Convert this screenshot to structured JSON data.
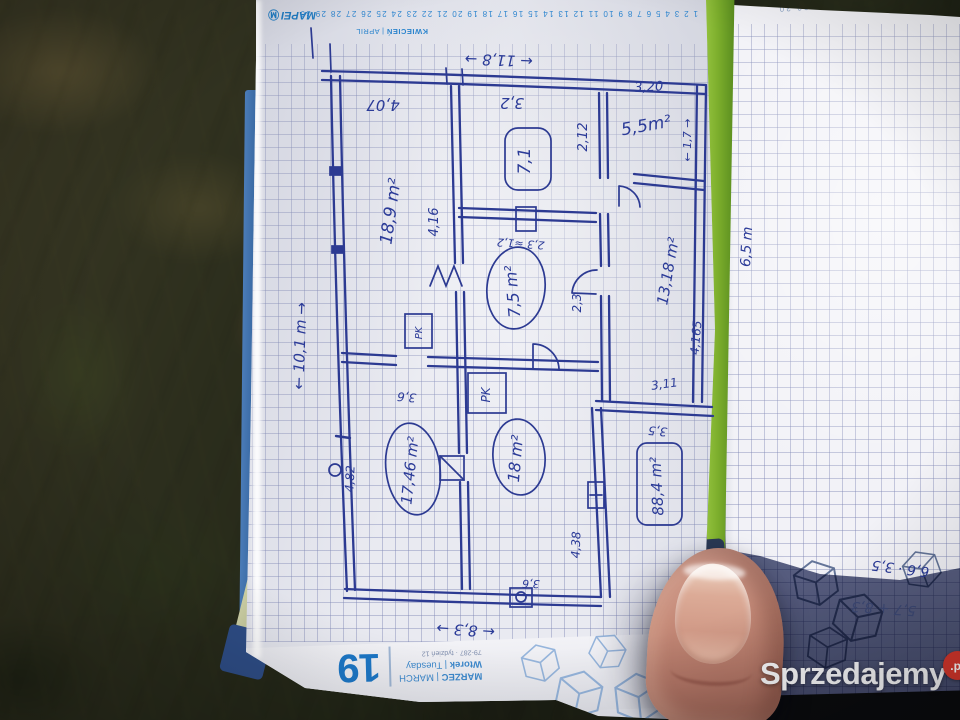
{
  "planner": {
    "brand": "MAPEI",
    "brand_badge": "Ⓜ",
    "april_header_pl": "KWIECIEŃ",
    "april_header_sep": " | APRIL",
    "april_dates": "1 2 3 4 5 6 7 8 9 10 11 12 13 14 15 16 17 18 19 20 21 22 23 24 25 26 27 28 29 30",
    "next_page_dates": "21 22 23 24 25 26 27 28 29 30",
    "day_number": "19",
    "month_line_bold": "MARZEC",
    "month_line_rest": " | MARCH",
    "weekday_line_bold": "Wtorek",
    "weekday_line_rest": " | Tuesday",
    "meta_line": "79-287 · tydzień 12"
  },
  "floorplan": {
    "areas": {
      "room1": "18,9 m²",
      "room2": "7,1",
      "room3": "5,5m²",
      "room4": "13,18 m²",
      "hall": "7,5 m²",
      "room6": "17,46 m²",
      "room7": "18 m²",
      "total": "88,4 m²"
    },
    "dims": {
      "width_top": "← 11,8 →",
      "height_left": "← 10,1 m →",
      "width_bottom": "← 8,3 →",
      "d407": "4,07",
      "d32": "3,2",
      "d320": "3,20",
      "d212": "2,12",
      "d416": "4,16",
      "d23a": "2,3 ≈1,2",
      "d23b": "2,3",
      "d17": "← 1,7 →",
      "d4165": "4,165",
      "d311": "3,11",
      "d35": "3,5",
      "d36a": "3,6",
      "d482": "4,82",
      "d438": "4,38",
      "d36b": "3,6",
      "right_page_dim": "6,5 m"
    },
    "fixtures": {
      "pk1": "PK",
      "pk2": "PK"
    },
    "calc": {
      "line1": "6,6 · 3,5",
      "line2": "5,7 + 8,3"
    }
  },
  "watermark": {
    "brand": "Sprzedajemy",
    "tld": ".pl"
  }
}
